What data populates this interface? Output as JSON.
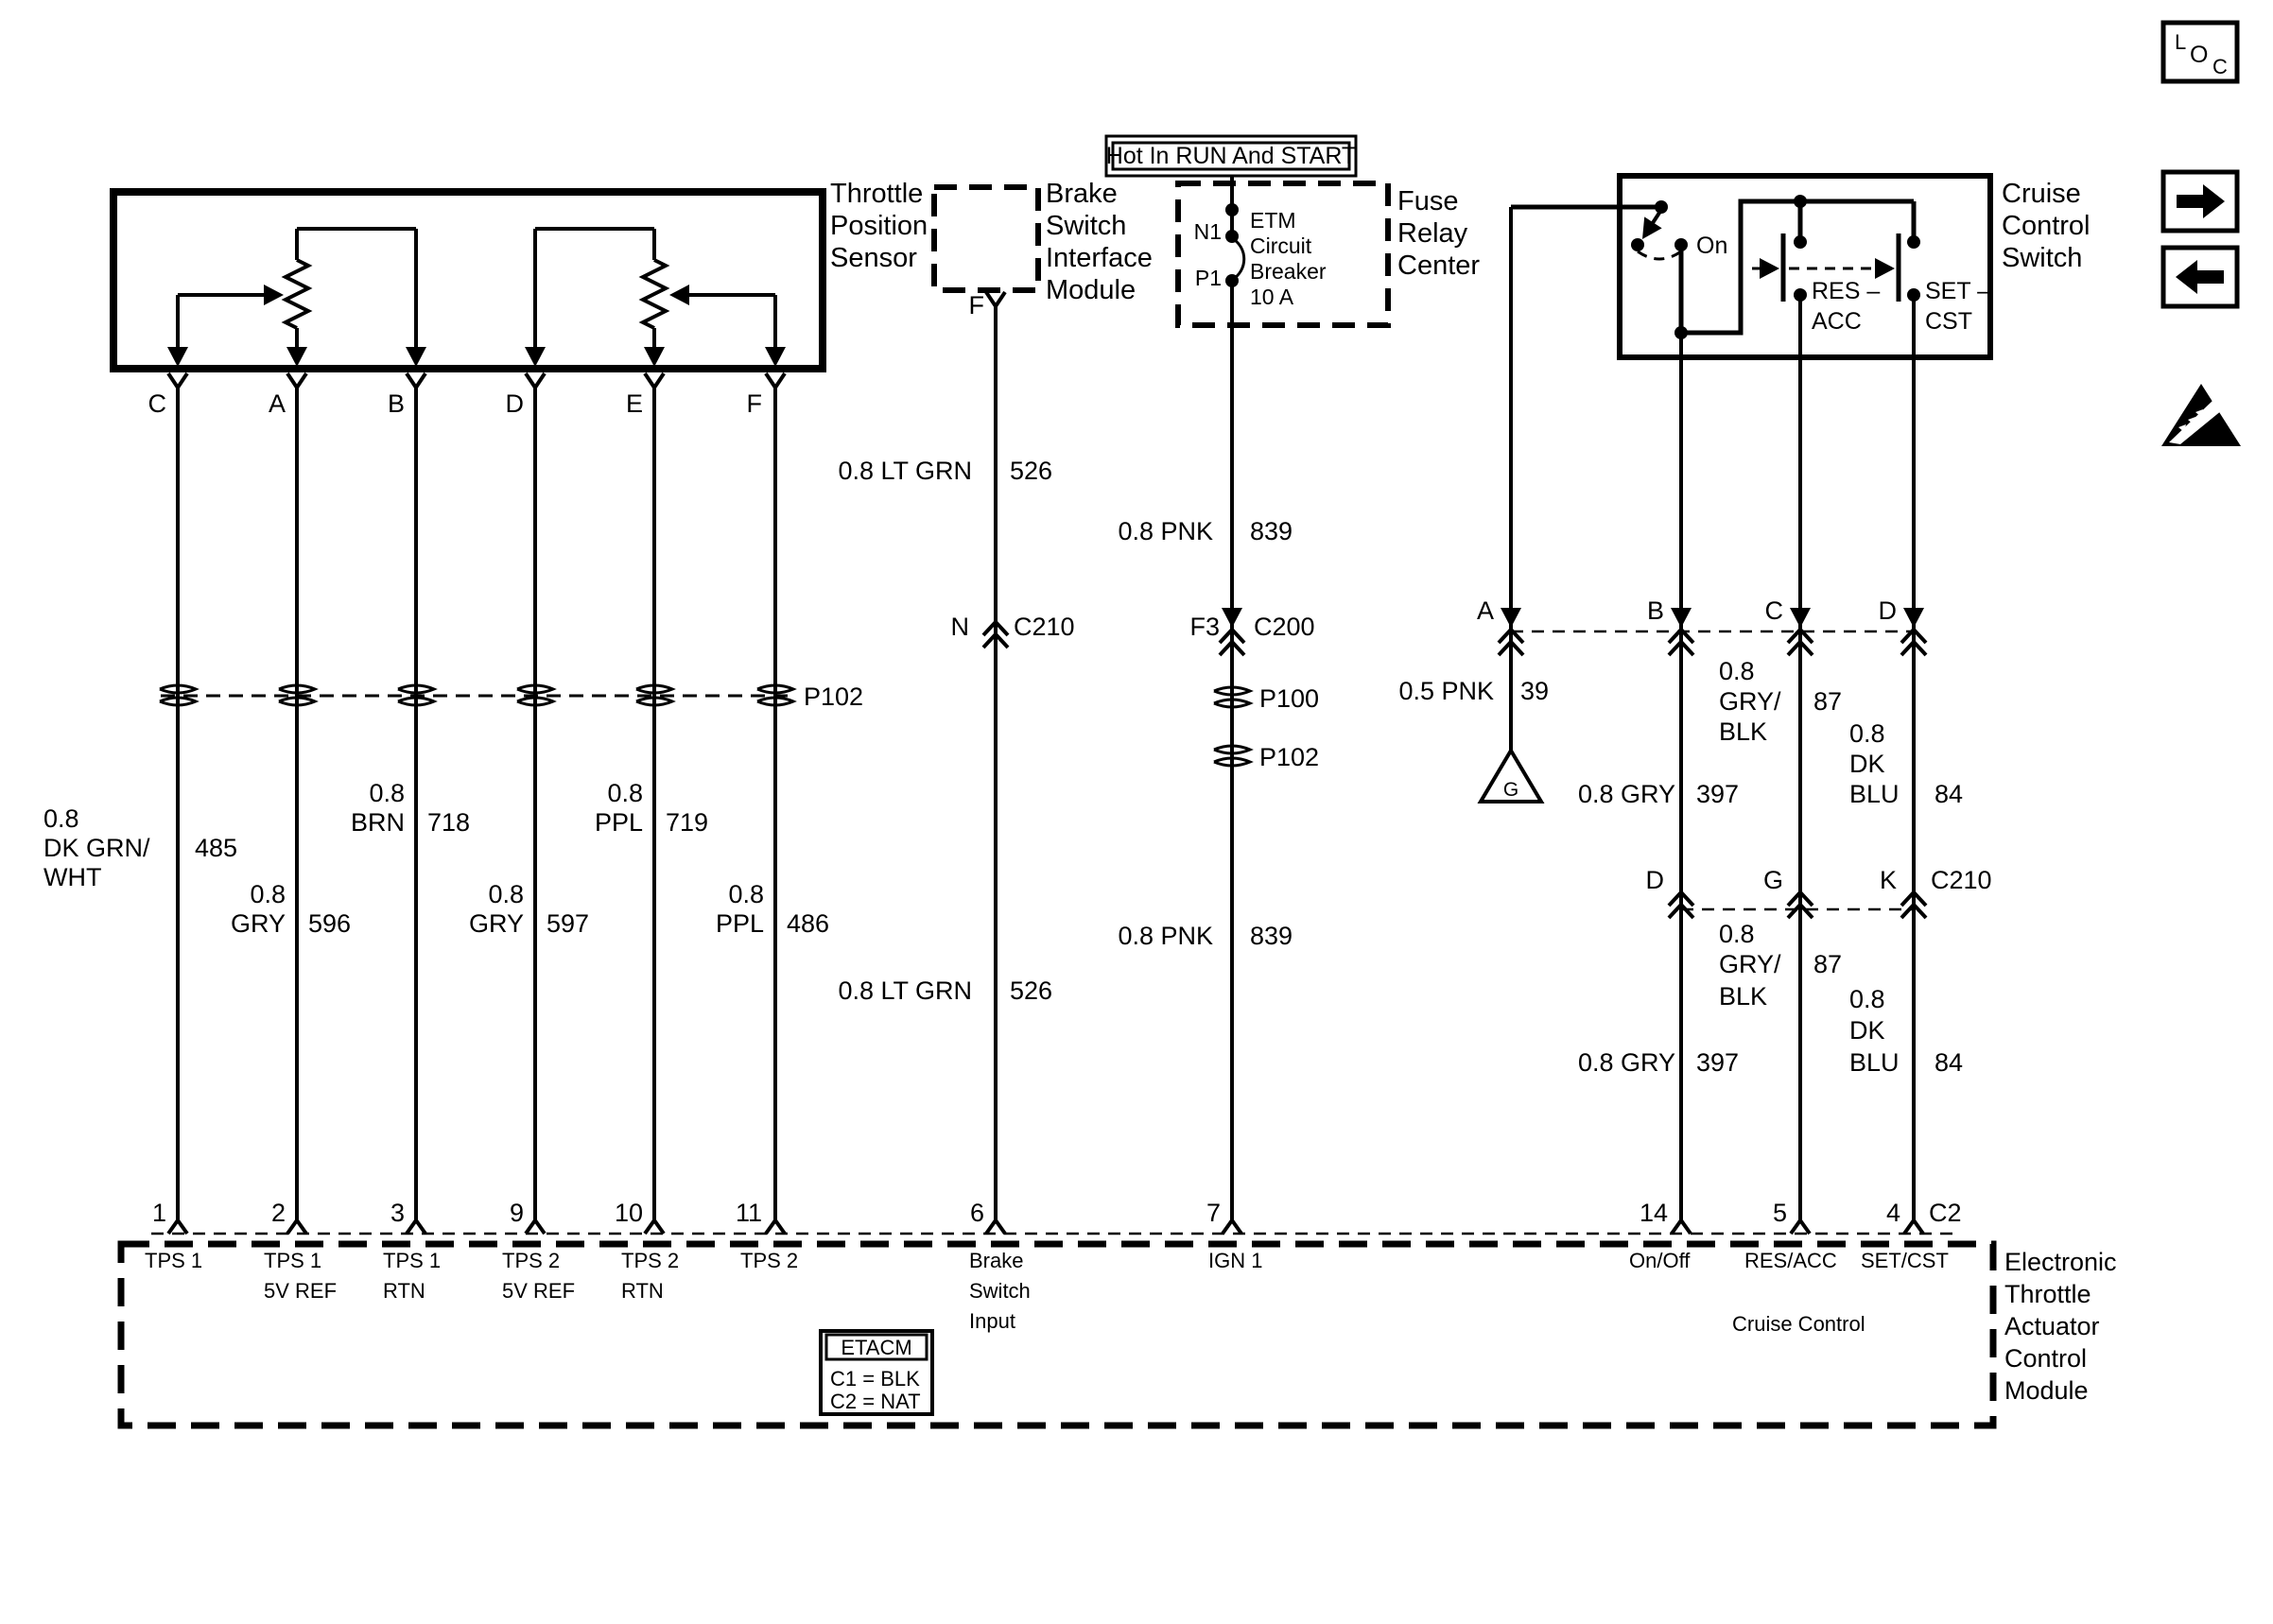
{
  "palette": {
    "ink": "#000000",
    "paper": "#ffffff"
  },
  "banner": {
    "hot": "Hot In RUN And START"
  },
  "corner_icons": {
    "loc": {
      "letters": [
        "L",
        "O",
        "C"
      ]
    },
    "nav_right": "forward-arrow-icon",
    "nav_left": "back-arrow-icon",
    "esd": "esd-warning-icon"
  },
  "components": {
    "tps": {
      "label": [
        "Throttle",
        "Position",
        "Sensor"
      ],
      "pin_letters": [
        "C",
        "A",
        "B",
        "D",
        "E",
        "F"
      ]
    },
    "brake_module": {
      "label": [
        "Brake",
        "Switch",
        "Interface",
        "Module"
      ],
      "pin": "F"
    },
    "fuse_center": {
      "label": [
        "Fuse",
        "Relay",
        "Center"
      ],
      "pin_top": "N1",
      "pin_bottom": "P1",
      "breaker": [
        "ETM",
        "Circuit",
        "Breaker",
        "10 A"
      ]
    },
    "cruise_switch": {
      "label": [
        "Cruise",
        "Control",
        "Switch"
      ],
      "on": "On",
      "res": [
        "RES –",
        "ACC"
      ],
      "set": [
        "SET –",
        "CST"
      ]
    },
    "ground": "G",
    "etacm": {
      "label": [
        "Electronic",
        "Throttle",
        "Actuator",
        "Control",
        "Module"
      ],
      "legend_title": "ETACM",
      "legend_rows": [
        "C1 = BLK",
        "C2 = NAT"
      ],
      "cruise_section": "Cruise Control"
    }
  },
  "wire_labels": {
    "tps_485": {
      "color": [
        "0.8",
        "DK GRN/",
        "WHT"
      ],
      "id": "485"
    },
    "tps_596": {
      "color": [
        "0.8",
        "GRY"
      ],
      "id": "596"
    },
    "tps_718": {
      "color": [
        "0.8",
        "BRN"
      ],
      "id": "718"
    },
    "tps_597": {
      "color": [
        "0.8",
        "GRY"
      ],
      "id": "597"
    },
    "tps_719": {
      "color": [
        "0.8",
        "PPL"
      ],
      "id": "719"
    },
    "tps_486": {
      "color": [
        "0.8",
        "PPL"
      ],
      "id": "486"
    },
    "ltgrn_upper": {
      "color": "0.8 LT GRN",
      "id": "526"
    },
    "ltgrn_lower": {
      "color": "0.8 LT GRN",
      "id": "526"
    },
    "pnk_upper": {
      "color": "0.8 PNK",
      "id": "839"
    },
    "pnk_lower": {
      "color": "0.8 PNK",
      "id": "839"
    },
    "pnk_39": {
      "color": "0.5 PNK",
      "id": "39"
    },
    "gryblk_upper": {
      "color": [
        "0.8",
        "GRY/",
        "BLK"
      ],
      "id": "87"
    },
    "gryblk_lower": {
      "color": [
        "0.8",
        "GRY/",
        "BLK"
      ],
      "id": "87"
    },
    "dkblu_upper": {
      "color": [
        "0.8",
        "DK",
        "BLU"
      ],
      "id": "84"
    },
    "dkblu_lower": {
      "color": [
        "0.8",
        "DK",
        "BLU"
      ],
      "id": "84"
    },
    "gry_upper": {
      "color": "0.8 GRY",
      "id": "397"
    },
    "gry_lower": {
      "color": "0.8 GRY",
      "id": "397"
    }
  },
  "connectors": {
    "p102_row": "P102",
    "c210_n": {
      "pin": "N",
      "name": "C210"
    },
    "c200": {
      "pin": "F3",
      "name": "C200"
    },
    "p100": "P100",
    "p102_mid": "P102",
    "row1": {
      "pins": [
        "A",
        "B",
        "C",
        "D"
      ]
    },
    "row2": {
      "pins": [
        "D",
        "G",
        "K"
      ],
      "name": "C210"
    },
    "c2": "C2"
  },
  "module_pins": {
    "p1": {
      "num": "1",
      "label": [
        "TPS 1"
      ]
    },
    "p2": {
      "num": "2",
      "label": [
        "TPS 1",
        "5V REF"
      ]
    },
    "p3": {
      "num": "3",
      "label": [
        "TPS 1",
        "RTN"
      ]
    },
    "p9": {
      "num": "9",
      "label": [
        "TPS 2",
        "5V REF"
      ]
    },
    "p10": {
      "num": "10",
      "label": [
        "TPS 2",
        "RTN"
      ]
    },
    "p11": {
      "num": "11",
      "label": [
        "TPS 2"
      ]
    },
    "p6": {
      "num": "6",
      "label": [
        "Brake",
        "Switch",
        "Input"
      ]
    },
    "p7": {
      "num": "7",
      "label": [
        "IGN 1"
      ]
    },
    "p14": {
      "num": "14",
      "label": [
        "On/Off"
      ]
    },
    "p5": {
      "num": "5",
      "label": [
        "RES/ACC"
      ]
    },
    "p4": {
      "num": "4",
      "label": [
        "SET/CST"
      ]
    }
  }
}
